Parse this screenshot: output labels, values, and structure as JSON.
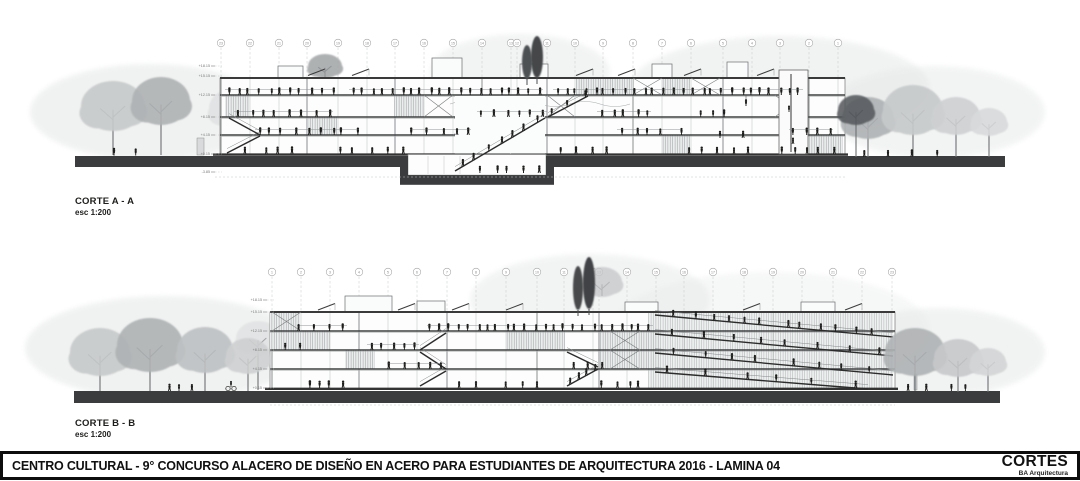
{
  "sheet": {
    "title": "CENTRO CULTURAL - 9° CONCURSO ALACERO DE DISEÑO EN ACERO PARA ESTUDIANTES DE ARQUITECTURA 2016 - LAMINA 04",
    "block_name": "CORTES",
    "studio": "BA Arquitectura"
  },
  "sections": [
    {
      "id": "corte-a",
      "label": "CORTE A - A",
      "scale": "esc 1:200",
      "grid_numbers": [
        "23",
        "22",
        "21",
        "20",
        "19",
        "18",
        "17",
        "16",
        "15",
        "14",
        "13",
        "12",
        "11",
        "10",
        "9",
        "8",
        "7",
        "6",
        "5",
        "4",
        "3",
        "2",
        "1"
      ],
      "level_labels": [
        "+18.15",
        "+15.15",
        "+12.15",
        "+8.15",
        "+4.15",
        "+0.15",
        "-3.85"
      ]
    },
    {
      "id": "corte-b",
      "label": "CORTE B - B",
      "scale": "esc 1:200",
      "grid_numbers": [
        "1",
        "2",
        "3",
        "4",
        "5",
        "6",
        "7",
        "8",
        "9",
        "10",
        "11",
        "12",
        "13",
        "14",
        "15",
        "16",
        "17",
        "18",
        "19",
        "20",
        "21",
        "22",
        "23"
      ],
      "level_labels": [
        "+18.15",
        "+15.15",
        "+12.15",
        "+8.15",
        "+4.15",
        "+0.15"
      ]
    }
  ],
  "colors": {
    "ink": "#1d1d1b",
    "ground": "#3a3c3e",
    "slab": "#3f4142",
    "grid_line": "#c6c8c8",
    "grid_text": "#8a8a8a",
    "paper": "#ffffff",
    "tree_light": "#c7cacb",
    "tree_mid": "#afb2b4",
    "tree_dark": "#53565a"
  }
}
